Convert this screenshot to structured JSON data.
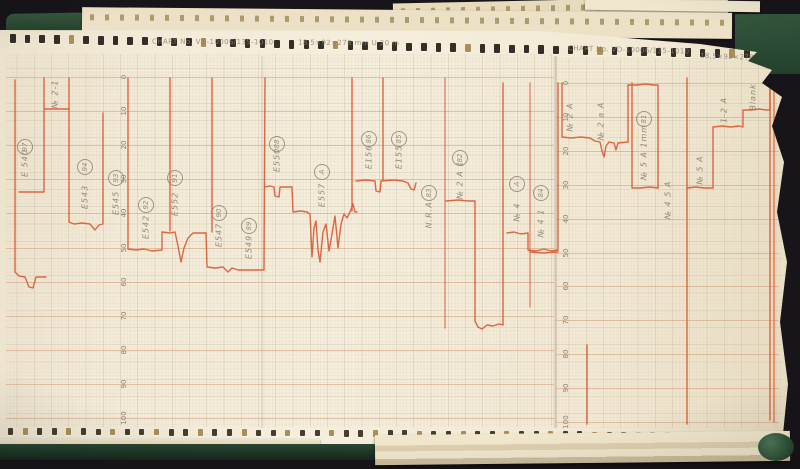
{
  "colors": {
    "background": "#18151a",
    "binder_green": "#2d4b36",
    "paper": "#f3ebd8",
    "grid_minor": "#ddd2bd",
    "grid_major": "#b9aa90",
    "grid_accent": "#d29b7c",
    "trace_red": "#d95b36",
    "pencil": "#82786a",
    "print_gray": "#8d8069"
  },
  "paper": {
    "headers": {
      "left": {
        "chart_no": "CHART No. VD-10006/135-1010",
        "dimensions": "18,5×92×278 mm U 20 m"
      },
      "right": {
        "chart_no": "CHART No. VD-10006/135-1010",
        "dimensions": "18,5×92×278 m"
      }
    },
    "scales": [
      {
        "name": "left",
        "x": 124,
        "y0": 77,
        "step": 34.1,
        "x1": 6,
        "x2": 554,
        "values": [
          "0",
          "10",
          "20",
          "30",
          "40",
          "50",
          "60",
          "70",
          "80",
          "90",
          "100"
        ]
      },
      {
        "name": "right",
        "x": 566,
        "y0": 83,
        "step": 33.9,
        "x1": 556,
        "x2": 779,
        "values": [
          "0",
          "10",
          "20",
          "30",
          "40",
          "50",
          "60",
          "70",
          "80",
          "90",
          "100"
        ]
      }
    ],
    "annotations": [
      {
        "label": "№ 2-1",
        "x": 55,
        "y": 94
      },
      {
        "label": "E 540",
        "circle": "97",
        "x": 25,
        "y": 163,
        "cy": 147
      },
      {
        "label": "E543",
        "circle": "94",
        "x": 85,
        "y": 197,
        "cy": 167
      },
      {
        "label": "E545",
        "circle": "93",
        "x": 116,
        "y": 203,
        "cy": 178
      },
      {
        "label": "E542",
        "circle": "92",
        "x": 146,
        "y": 227,
        "cy": 205
      },
      {
        "label": "E552",
        "circle": "91",
        "x": 175,
        "y": 204,
        "cy": 178
      },
      {
        "label": "E547",
        "circle": "90",
        "x": 219,
        "y": 235,
        "cy": 213
      },
      {
        "label": "E549",
        "circle": "89",
        "x": 249,
        "y": 247,
        "cy": 226
      },
      {
        "label": "E550",
        "circle": "88",
        "x": 277,
        "y": 160,
        "cy": 144
      },
      {
        "label": "E557",
        "circle": "A",
        "x": 322,
        "y": 195,
        "cy": 172
      },
      {
        "label": "E156",
        "circle": "86",
        "x": 369,
        "y": 157,
        "cy": 139
      },
      {
        "label": "E155",
        "circle": "85",
        "x": 399,
        "y": 157,
        "cy": 139
      },
      {
        "label": "N.R.A.",
        "circle": "83",
        "x": 429,
        "y": 213,
        "cy": 193
      },
      {
        "label": "№ 2 A 1",
        "circle": "82",
        "x": 460,
        "y": 180,
        "cy": 158
      },
      {
        "label": "№ 4",
        "circle": "A",
        "x": 517,
        "y": 212,
        "cy": 184
      },
      {
        "label": "№ 4 1",
        "circle": "84",
        "x": 541,
        "y": 223,
        "cy": 193
      },
      {
        "label": "№ 2 A",
        "x": 570,
        "y": 117
      },
      {
        "label": "№ 2 a A",
        "x": 601,
        "y": 121
      },
      {
        "label": "№ 5 A 1mm",
        "circle": "81",
        "x": 644,
        "y": 152,
        "cy": 119
      },
      {
        "label": "№ 4 5 A",
        "x": 668,
        "y": 200
      },
      {
        "label": "№ 5 A",
        "x": 700,
        "y": 170
      },
      {
        "label": "1-2 A",
        "x": 724,
        "y": 110
      },
      {
        "label": "Blank",
        "x": 753,
        "y": 97
      }
    ],
    "chart_data": {
      "type": "line",
      "title": "Analog strip-chart recorder traces (two chart sections, scale 0–100)",
      "ylim": [
        0,
        100
      ],
      "traces": [
        {
          "points": [
            [
              15,
              80
            ],
            [
              15,
              272
            ],
            [
              19,
              276
            ],
            [
              25,
              277
            ],
            [
              29,
              287
            ],
            [
              33,
              288
            ],
            [
              36,
              277
            ],
            [
              46,
              277
            ]
          ]
        },
        {
          "points": [
            [
              19,
              192
            ],
            [
              44,
              192
            ],
            [
              44,
              78
            ]
          ]
        },
        {
          "points": [
            [
              45,
              109
            ],
            [
              69,
              109
            ]
          ]
        },
        {
          "points": [
            [
              69,
              78
            ],
            [
              69,
              222
            ],
            [
              74,
              224
            ],
            [
              82,
              223
            ],
            [
              90,
              224
            ],
            [
              95,
              230
            ],
            [
              99,
              225
            ],
            [
              103,
              224
            ],
            [
              103,
              113
            ]
          ]
        },
        {
          "points": [
            [
              128,
              78
            ],
            [
              128,
              249
            ],
            [
              136,
              250
            ],
            [
              144,
              249
            ],
            [
              152,
              251
            ],
            [
              162,
              250
            ],
            [
              162,
              232
            ],
            [
              170,
              233
            ],
            [
              175,
              232
            ],
            [
              178,
              246
            ],
            [
              181,
              262
            ],
            [
              184,
              248
            ],
            [
              188,
              238
            ],
            [
              193,
              233
            ],
            [
              206,
              233
            ],
            [
              207,
              267
            ],
            [
              215,
              268
            ],
            [
              223,
              267
            ],
            [
              228,
              272
            ],
            [
              232,
              268
            ],
            [
              238,
              270
            ],
            [
              250,
              270
            ],
            [
              264,
              270
            ],
            [
              265,
              78
            ]
          ]
        },
        {
          "points": [
            [
              170,
              78
            ],
            [
              170,
              231
            ]
          ]
        },
        {
          "points": [
            [
              212,
              78
            ],
            [
              212,
              232
            ]
          ]
        },
        {
          "points": [
            [
              265,
              187
            ],
            [
              270,
              186
            ],
            [
              274,
              187
            ],
            [
              275,
              196
            ],
            [
              279,
              197
            ],
            [
              280,
              187
            ],
            [
              292,
              187
            ],
            [
              293,
              212
            ],
            [
              301,
              211
            ],
            [
              307,
              212
            ],
            [
              310,
              214
            ],
            [
              312,
              257
            ],
            [
              314,
              228
            ],
            [
              316,
              221
            ],
            [
              318,
              250
            ],
            [
              320,
              262
            ],
            [
              323,
              232
            ],
            [
              326,
              224
            ],
            [
              329,
              251
            ],
            [
              332,
              234
            ],
            [
              335,
              216
            ],
            [
              338,
              248
            ],
            [
              341,
              224
            ],
            [
              344,
              214
            ],
            [
              347,
              218
            ],
            [
              350,
              212
            ],
            [
              353,
              204
            ],
            [
              355,
              212
            ],
            [
              357,
              212
            ]
          ]
        },
        {
          "points": [
            [
              356,
              181
            ],
            [
              366,
              180
            ],
            [
              375,
              181
            ],
            [
              376,
              191
            ],
            [
              380,
              192
            ],
            [
              381,
              181
            ],
            [
              394,
              180
            ],
            [
              403,
              181
            ],
            [
              408,
              183
            ],
            [
              411,
              189
            ],
            [
              414,
              190
            ],
            [
              416,
              183
            ]
          ]
        },
        {
          "points": [
            [
              352,
              78
            ],
            [
              352,
              211
            ]
          ]
        },
        {
          "points": [
            [
              383,
              78
            ],
            [
              383,
              180
            ]
          ]
        },
        {
          "points": [
            [
              445,
              78
            ],
            [
              445,
              328
            ]
          ],
          "op": 0.7
        },
        {
          "points": [
            [
              446,
              201
            ],
            [
              458,
              200
            ],
            [
              468,
              201
            ],
            [
              475,
              201
            ],
            [
              475,
              321
            ],
            [
              478,
              327
            ],
            [
              482,
              329
            ],
            [
              487,
              325
            ],
            [
              493,
              326
            ],
            [
              499,
              324
            ],
            [
              503,
              325
            ],
            [
              503,
              83
            ]
          ]
        },
        {
          "points": [
            [
              530,
              83
            ],
            [
              530,
              307
            ]
          ],
          "op": 0.65
        },
        {
          "points": [
            [
              507,
              233
            ],
            [
              514,
              232
            ],
            [
              521,
              234
            ],
            [
              528,
              233
            ],
            [
              528,
              250
            ],
            [
              536,
              251
            ],
            [
              544,
              249
            ],
            [
              551,
              251
            ],
            [
              558,
              250
            ],
            [
              558,
              83
            ]
          ]
        },
        {
          "points": [
            [
              530,
              252
            ],
            [
              543,
              253
            ],
            [
              558,
              252
            ]
          ]
        },
        {
          "points": [
            [
              562,
              83
            ],
            [
              562,
              137
            ],
            [
              571,
              138
            ],
            [
              581,
              137
            ],
            [
              590,
              138
            ],
            [
              595,
              141
            ],
            [
              600,
              142
            ],
            [
              602,
              151
            ],
            [
              604,
              157
            ],
            [
              606,
              146
            ],
            [
              609,
              142
            ],
            [
              614,
              143
            ],
            [
              616,
              150
            ],
            [
              618,
              143
            ],
            [
              628,
              142
            ],
            [
              628,
              85
            ]
          ]
        },
        {
          "points": [
            [
              628,
              85
            ],
            [
              636,
              85
            ],
            [
              646,
              84
            ],
            [
              654,
              85
            ],
            [
              658,
              85
            ],
            [
              658,
              188
            ]
          ]
        },
        {
          "points": [
            [
              632,
              83
            ],
            [
              632,
              188
            ],
            [
              640,
              188
            ],
            [
              650,
              187
            ],
            [
              658,
              188
            ]
          ]
        },
        {
          "points": [
            [
              687,
              78
            ],
            [
              687,
              424
            ]
          ]
        },
        {
          "points": [
            [
              687,
              188
            ],
            [
              696,
              187
            ],
            [
              704,
              188
            ],
            [
              713,
              188
            ],
            [
              713,
              127
            ],
            [
              722,
              126
            ],
            [
              731,
              127
            ],
            [
              739,
              126
            ],
            [
              743,
              127
            ],
            [
              743,
              110
            ],
            [
              751,
              110
            ],
            [
              759,
              109
            ],
            [
              766,
              110
            ],
            [
              770,
              110
            ],
            [
              770,
              82
            ]
          ]
        },
        {
          "points": [
            [
              770,
              82
            ],
            [
              770,
              420
            ]
          ]
        },
        {
          "points": [
            [
              774,
              86
            ],
            [
              774,
              422
            ]
          ],
          "op": 0.8
        },
        {
          "points": [
            [
              587,
              345
            ],
            [
              587,
              424
            ]
          ]
        }
      ]
    }
  },
  "sprockets": {
    "top": {
      "x0": 10,
      "count": 51,
      "step": 14.68,
      "y0": 34,
      "slope": 0.021,
      "w": 5.5,
      "h": 8.5
    },
    "bottom": {
      "x0": 8,
      "count": 52,
      "step": 14.6,
      "y0": 428,
      "slope": 0.006,
      "w": 5,
      "h": 6.5
    }
  }
}
